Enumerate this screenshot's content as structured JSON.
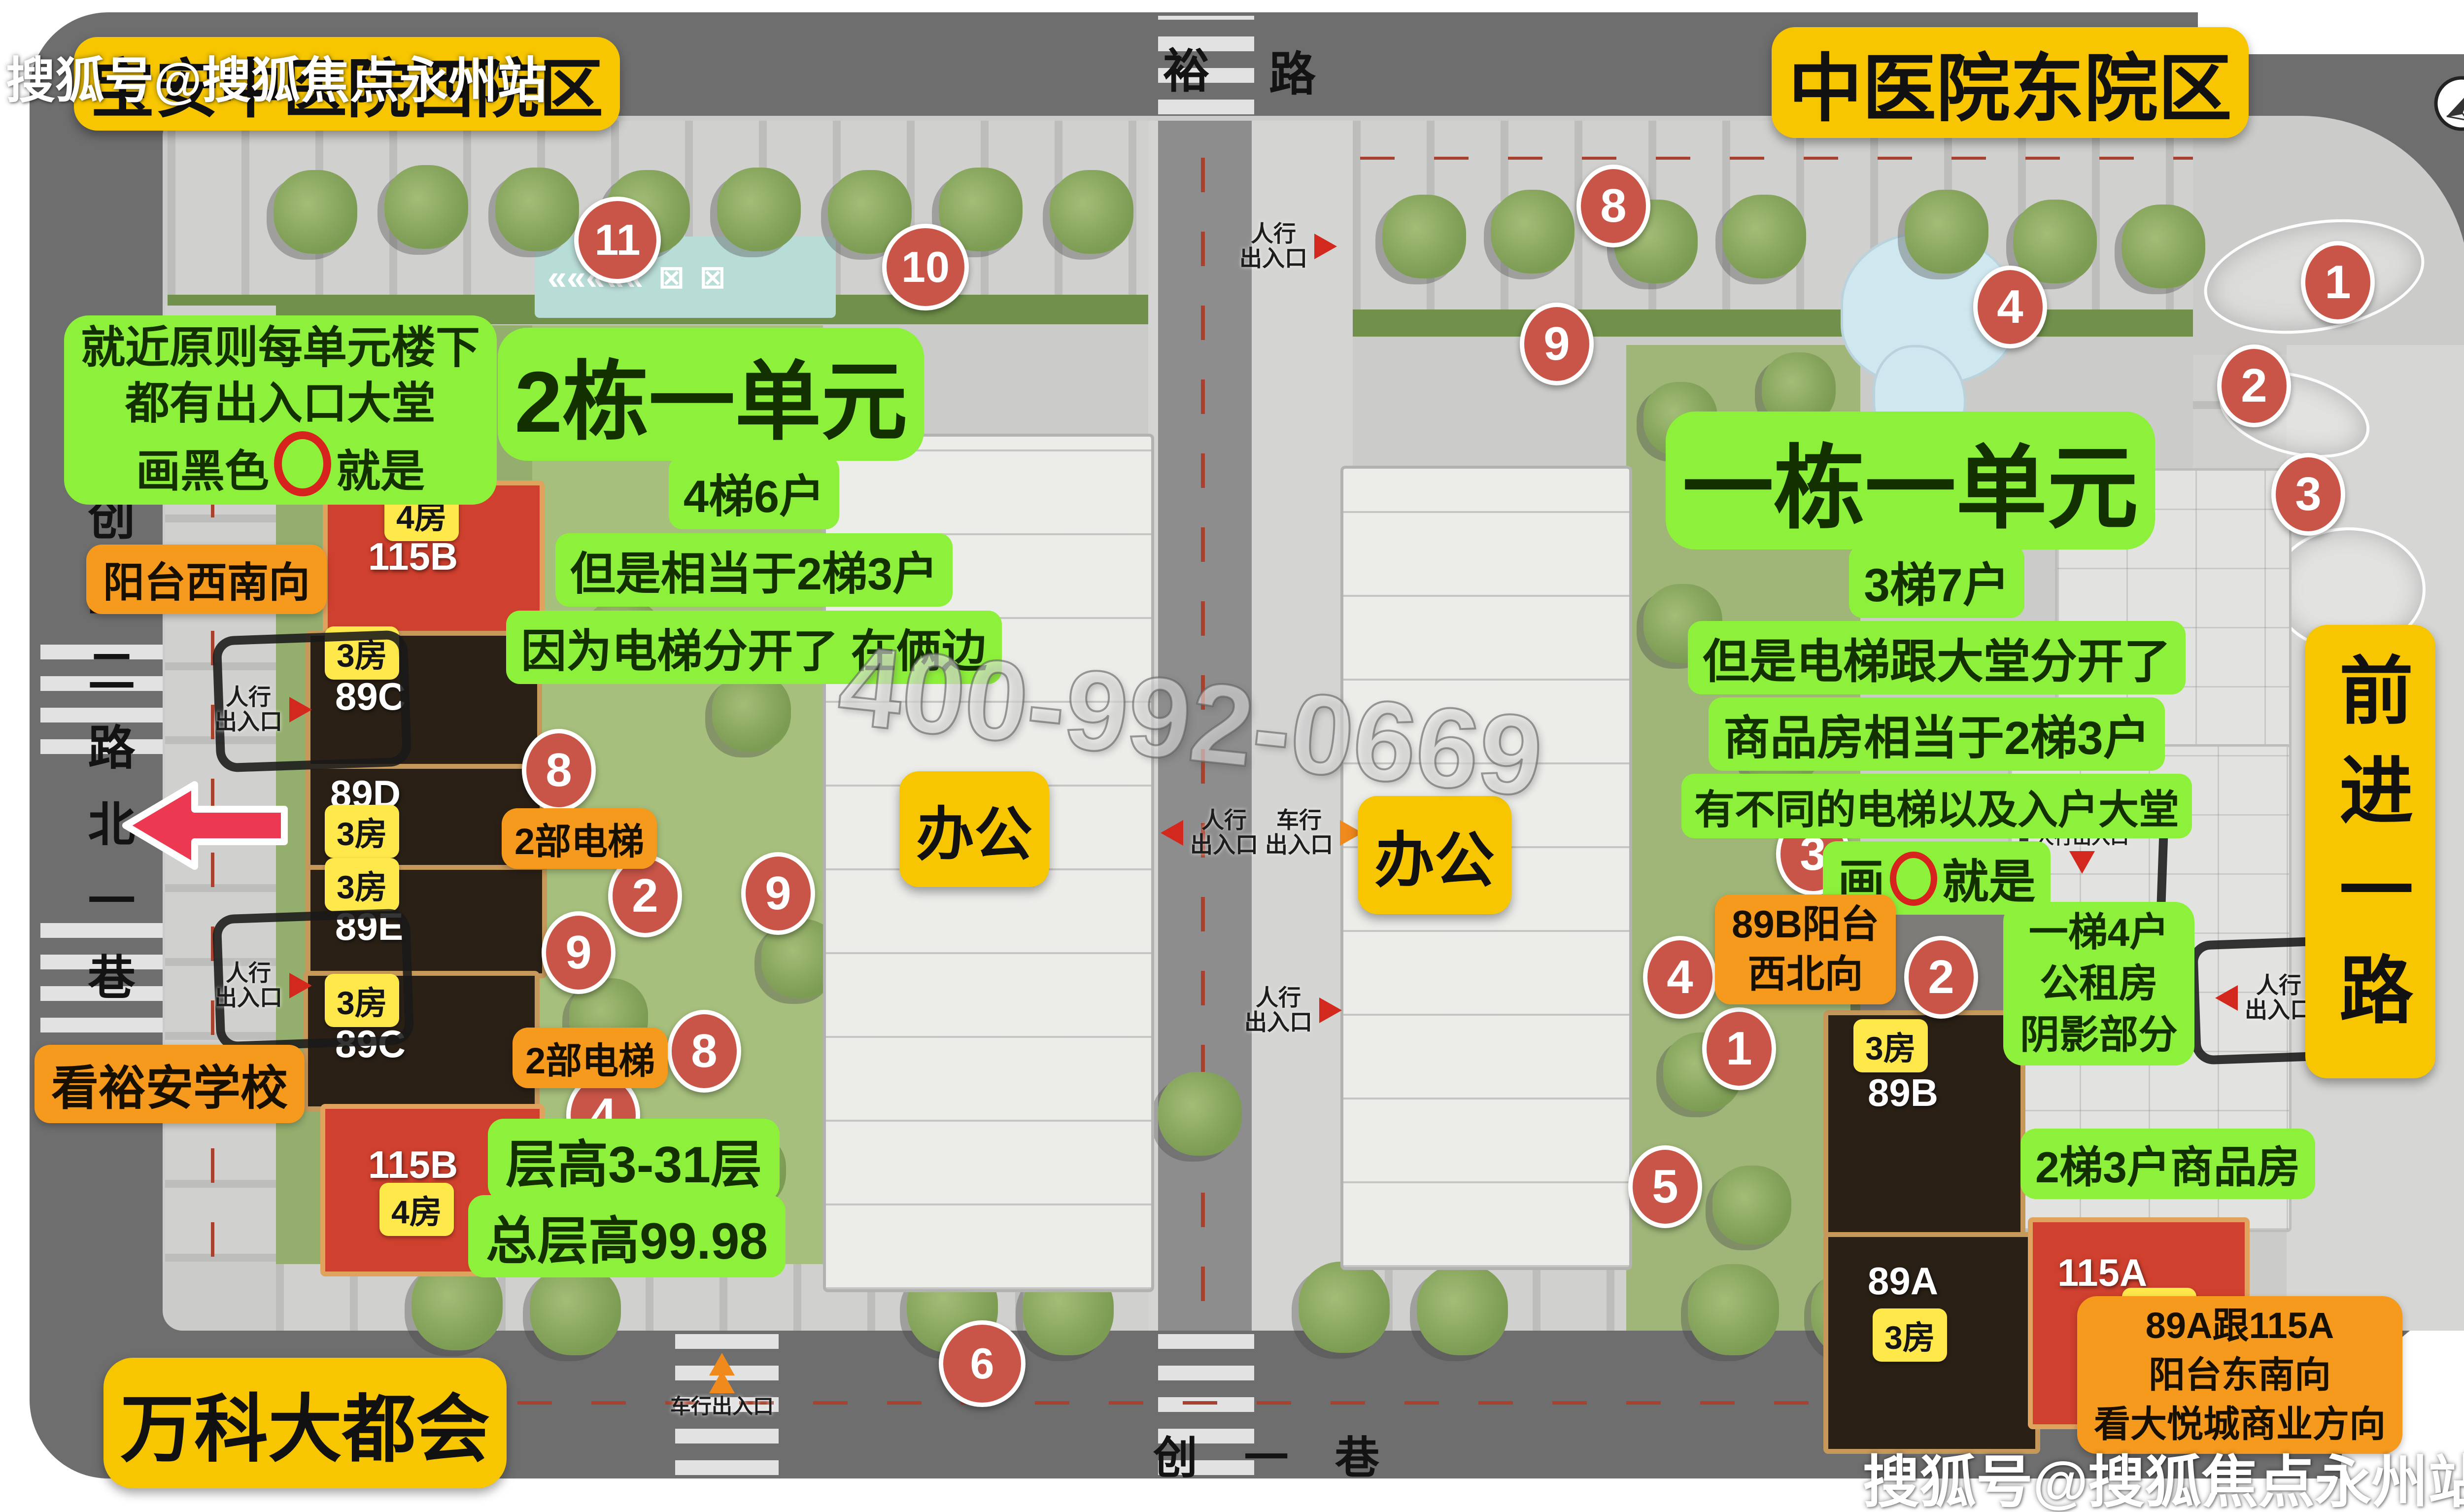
{
  "watermarks": {
    "sohu_top": "搜狐号@搜狐焦点永州站",
    "sohu_bottom": "搜狐号@搜狐焦点永州站",
    "phone": "400-992-0669"
  },
  "site_titles": {
    "west": "宝安中医院西院区",
    "east": "中医院东院区"
  },
  "roads": {
    "top_name": "裕",
    "top_name_suffix": "路",
    "left_name": "创业二路北一巷",
    "bottom_name": "创一巷",
    "right_name": "前进一路"
  },
  "west": {
    "near_rule_l1": "就近原则每单元楼下",
    "near_rule_l2": "都有出入口大堂",
    "near_rule_l3_pre": "画黑色",
    "near_rule_l3_post": "就是",
    "unit_title": "2栋一单元",
    "unit_l1": "4梯6户",
    "unit_l2": "但是相当于2梯3户",
    "unit_l3": "因为电梯分开了 在俩边",
    "balcony": "阳台西南向",
    "school": "看裕安学校",
    "floors": "层高3-31层",
    "total_height": "总层高99.98",
    "elevator_upper": "2部电梯",
    "elevator_lower": "2部电梯",
    "office": "办公",
    "vanke": "万科大都会"
  },
  "east": {
    "unit_title": "一栋一单元",
    "unit_l1": "3梯7户",
    "unit_l2": "但是电梯跟大堂分开了",
    "unit_l3": "商品房相当于2梯3户",
    "unit_l4": "有不同的电梯以及入户大堂",
    "unit_l5_pre": "画",
    "unit_l5_post": "就是",
    "office": "办公",
    "b89b_l1": "89B阳台",
    "b89b_l2": "西北向",
    "rental_l1": "一梯4户",
    "rental_l2": "公租房",
    "rental_l3": "阴影部分",
    "commodity": "2梯3户商品房",
    "a115_l1": "89A跟115A",
    "a115_l2": "阳台东南向",
    "a115_l3": "看大悦城商业方向"
  },
  "buildings": {
    "w115b_top": {
      "chip": "4房",
      "name": "115B"
    },
    "w89c_top": {
      "chip": "3房",
      "name": "89C"
    },
    "w89d": {
      "name": "89D",
      "chip": "3房"
    },
    "w89e": {
      "chip": "3房",
      "name": "89E"
    },
    "w89c_bottom": {
      "chip": "3房",
      "name": "89C"
    },
    "w115b_bottom": {
      "name": "115B",
      "chip": "4房"
    },
    "e89b": {
      "chip": "3房",
      "name": "89B"
    },
    "e89a": {
      "name": "89A",
      "chip": "3房"
    },
    "e115a": {
      "name": "115A",
      "chip": "4房"
    }
  },
  "entrances": {
    "ped_l1": "人行",
    "ped_l2": "出入口",
    "ped": "人行出入口",
    "veh_l1": "车行",
    "veh_l2": "出入口",
    "veh": "车行出入口"
  },
  "markers": {
    "c11": "11",
    "c10": "10",
    "c8a": "8",
    "c2a": "2",
    "c9a": "9",
    "c9b": "9",
    "c8b": "8",
    "c4a": "4",
    "c6": "6",
    "c8c": "8",
    "c9c": "9",
    "c4b": "4",
    "c1a": "1",
    "c2b": "2",
    "c3a": "3",
    "c3b": "3",
    "c4c": "4",
    "c1b": "1",
    "c2c": "2",
    "c5": "5"
  },
  "colors": {
    "label_yellow": "#f7c600",
    "label_green": "#8df03a",
    "label_orange": "#f59a1d",
    "chip_yellow": "#ffe84a",
    "building_red": "#d0402e",
    "building_dark": "#2a2016",
    "marker_red": "#c85548",
    "road_gray": "#6e6e6e",
    "arrow_red": "#ec3850",
    "water_teal": "#b8dcd6",
    "pond_blue": "#cfe7ef"
  }
}
